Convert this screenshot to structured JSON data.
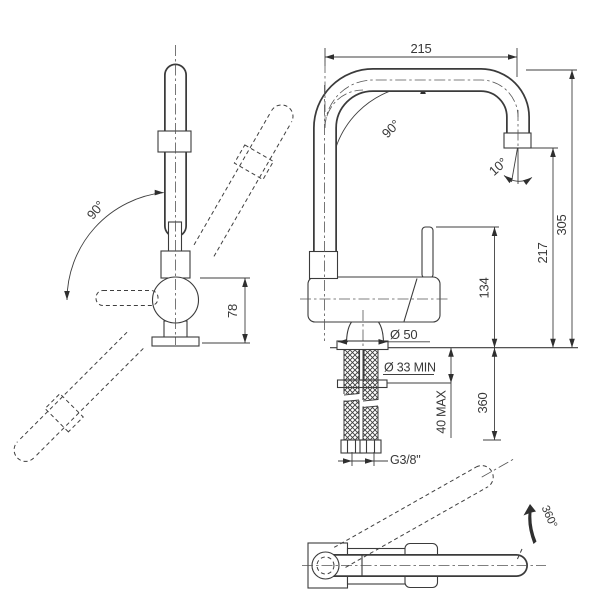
{
  "title": "faucet-technical-drawing",
  "colors": {
    "line": "#3b3b3b",
    "text": "#383838",
    "background": "#ffffff",
    "arrow_solid": "#1a1a1a"
  },
  "views": {
    "front": {
      "name": "front swivel view",
      "labels": {
        "swivel_angle": "90°",
        "body_height": "78"
      }
    },
    "side": {
      "name": "side elevation view",
      "labels": {
        "spout_reach": "215",
        "bend_angle": "90°",
        "outlet_angle": "10°",
        "total_height": "305",
        "outlet_height": "217",
        "handle_height": "134",
        "base_diameter": "Ø 50",
        "hole_diameter_min": "Ø 33 MIN",
        "counter_thickness_max": "40 MAX",
        "hose_depth": "360",
        "thread_size": "G3/8\""
      }
    },
    "top": {
      "name": "top rotation view",
      "labels": {
        "spout_rotation": "360°"
      }
    }
  }
}
